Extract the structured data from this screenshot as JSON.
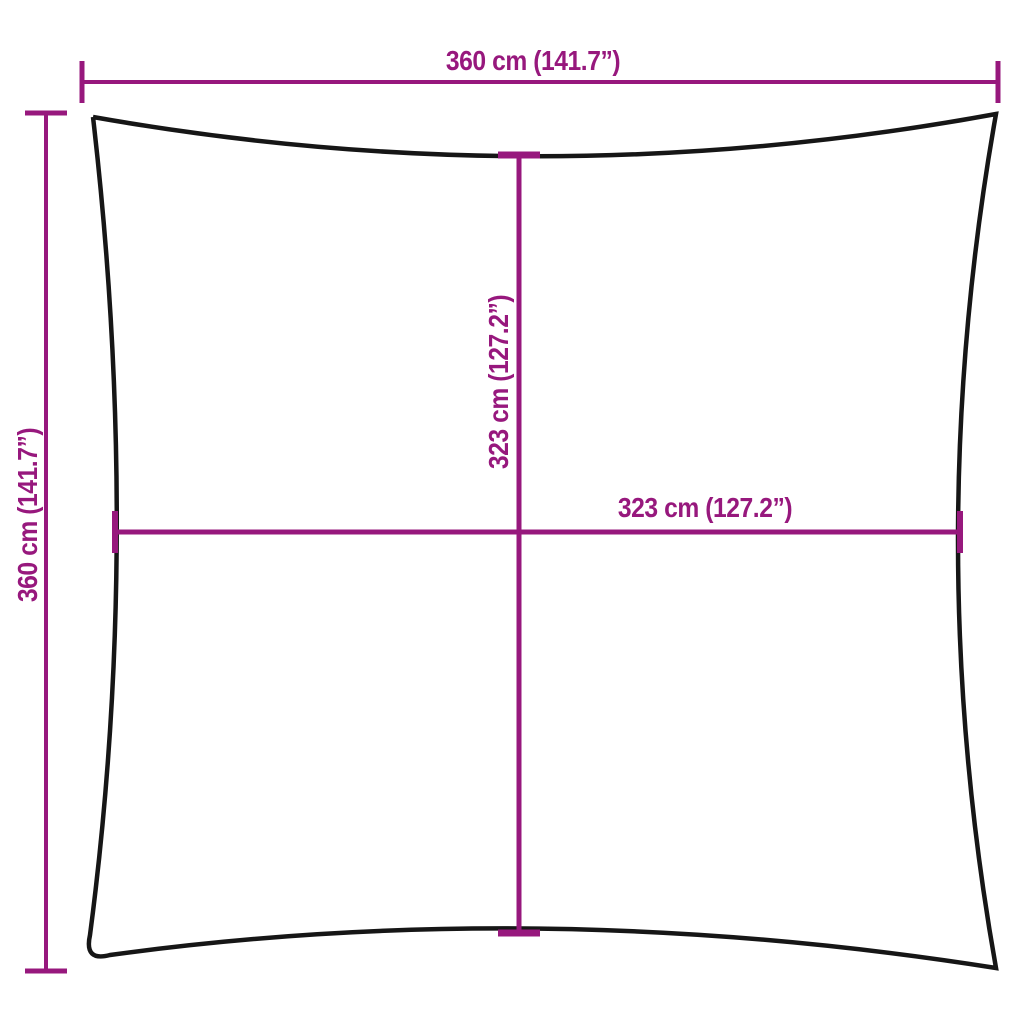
{
  "canvas": {
    "width": 1024,
    "height": 1024,
    "background": "#ffffff"
  },
  "colors": {
    "dimension_line": "#97187D",
    "outline": "#161616"
  },
  "diagram": {
    "type": "product-dimension-diagram",
    "subject": "square shade sail with concave edges",
    "dimensions": [
      {
        "id": "top-width",
        "label": "360 cm (141.7”)",
        "orientation": "horizontal",
        "position": "top edge, corner to corner"
      },
      {
        "id": "left-height",
        "label": "360 cm (141.7”)",
        "orientation": "vertical",
        "position": "left edge, corner to corner"
      },
      {
        "id": "center-height",
        "label": "323 cm (127.2”)",
        "orientation": "vertical",
        "position": "center, top edge to bottom edge"
      },
      {
        "id": "center-width",
        "label": "323 cm (127.2”)",
        "orientation": "horizontal",
        "position": "center, left edge to right edge"
      }
    ]
  }
}
